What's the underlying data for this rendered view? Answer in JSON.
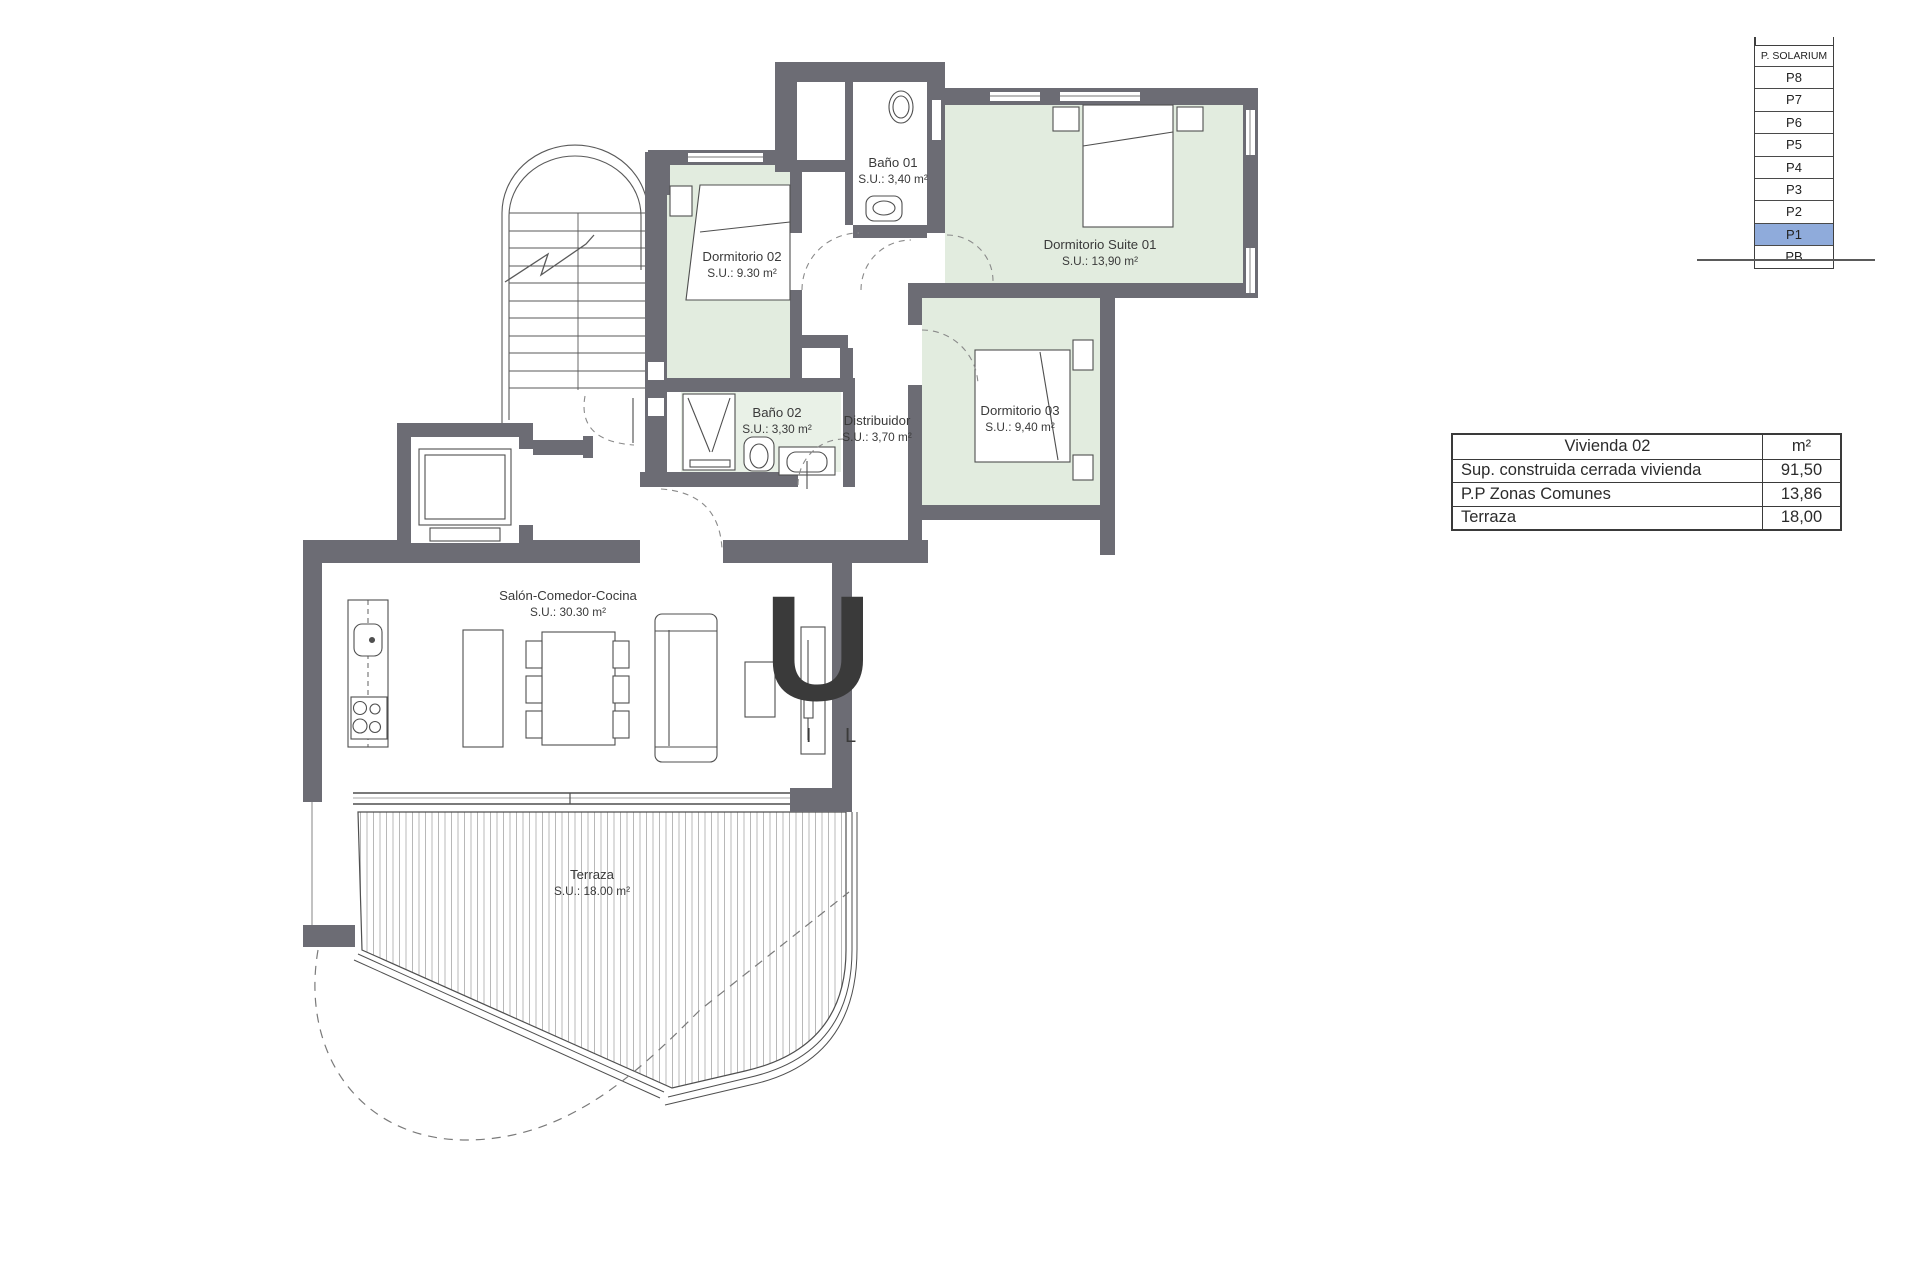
{
  "floor_plan": {
    "rooms": [
      {
        "id": "dormitorio-02",
        "name": "Dormitorio 02",
        "area": "S.U.: 9.30 m²"
      },
      {
        "id": "bano-01",
        "name": "Baño 01",
        "area": "S.U.: 3,40 m²"
      },
      {
        "id": "dormitorio-suite-01",
        "name": "Dormitorio Suite 01",
        "area": "S.U.: 13,90 m²"
      },
      {
        "id": "bano-02",
        "name": "Baño 02",
        "area": "S.U.: 3,30 m²"
      },
      {
        "id": "distribuidor",
        "name": "Distribuidor",
        "area": "S.U.: 3,70 m²"
      },
      {
        "id": "dormitorio-03",
        "name": "Dormitorio 03",
        "area": "S.U.: 9,40 m²"
      },
      {
        "id": "salon-comedor-cocina",
        "name": "Salón-Comedor-Cocina",
        "area": "S.U.: 30.30 m²"
      },
      {
        "id": "terraza",
        "name": "Terraza",
        "area": "S.U.: 18.00 m²"
      }
    ],
    "colors": {
      "wall": "#6c6c74",
      "room_green": "#e2ecdf",
      "bath_green": "#e9f1e7",
      "highlight_blue": "#8fabdb",
      "deck_line": "#b0b0b0"
    }
  },
  "level_indicator": {
    "header": "P. SOLARIUM",
    "levels": [
      "P8",
      "P7",
      "P6",
      "P5",
      "P4",
      "P3",
      "P2",
      "P1",
      "PB"
    ],
    "highlighted": "P1"
  },
  "area_table": {
    "title": "Vivienda 02",
    "unit": "m²",
    "rows": [
      {
        "label": "Sup. construida cerrada vivienda",
        "value": "91,50"
      },
      {
        "label": "P.P Zonas Comunes",
        "value": "13,86"
      },
      {
        "label": "Terraza",
        "value": "18,00"
      }
    ]
  },
  "watermark": {
    "letter": "U",
    "letters": "I L"
  }
}
